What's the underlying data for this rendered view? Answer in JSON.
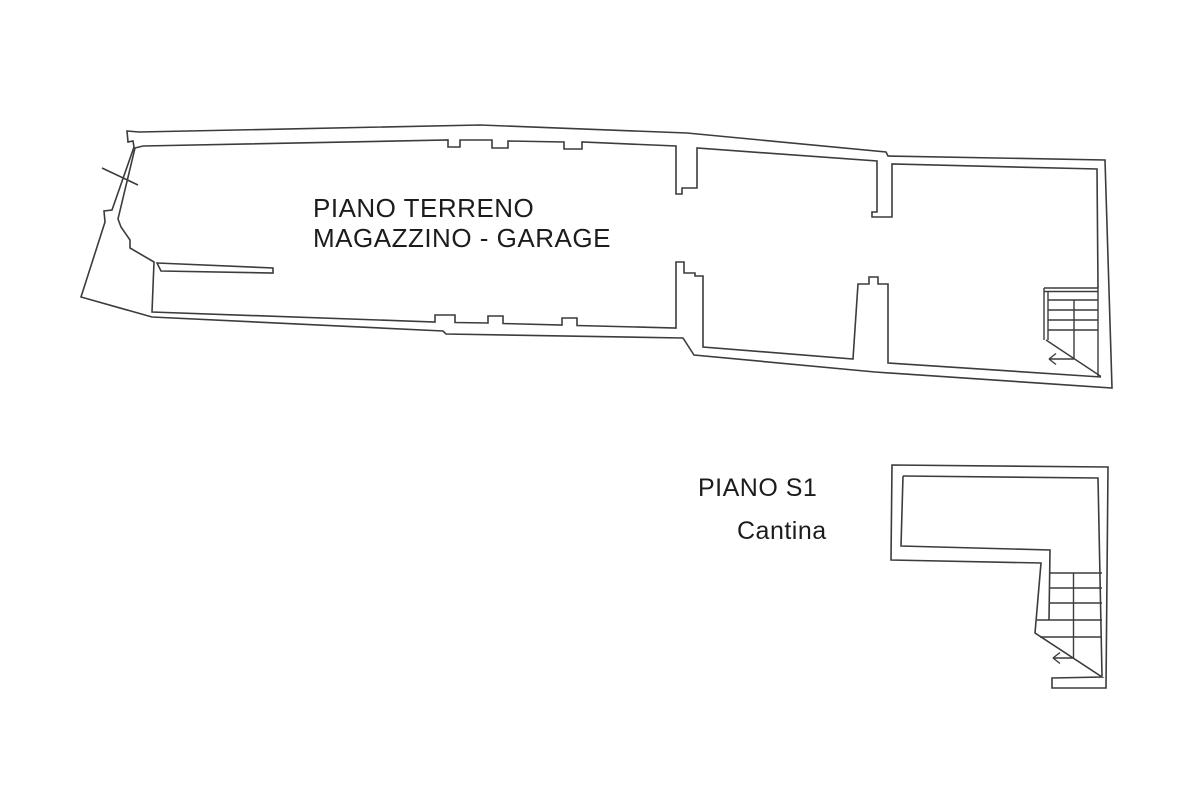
{
  "canvas": {
    "background": "#ffffff",
    "line_color": "#3c3c3c",
    "text_color": "#1c1c1c"
  },
  "ground_floor": {
    "label_line1": "PIANO TERRENO",
    "label_line2": "MAGAZZINO - GARAGE",
    "icons": [
      "stairs",
      "direction-arrow",
      "section-tick"
    ]
  },
  "basement": {
    "label": "PIANO S1",
    "room_label": "Cantina",
    "icons": [
      "stairs",
      "direction-arrow"
    ]
  }
}
